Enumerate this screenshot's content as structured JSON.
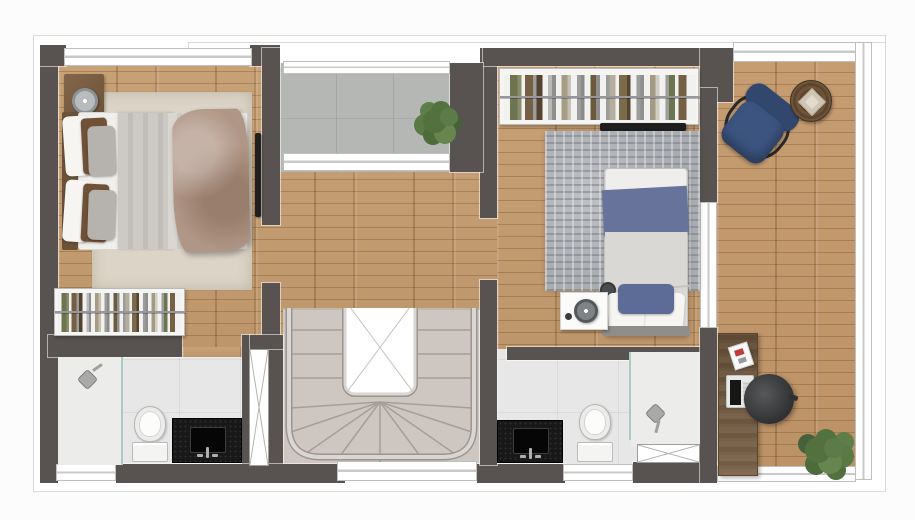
{
  "document": {
    "type": "architectural floor plan rendering",
    "view": "top-down upper floor",
    "visible_text": "none"
  },
  "palette": {
    "wall": "#585350",
    "wood": "#c59c6f",
    "deck": "#c3976a",
    "concrete": "#b5b7b5",
    "bath": "#e6e7e6",
    "stair": "#cec7c1",
    "rug1": "#dcd4c7",
    "rug2": "#a9acb1",
    "bed_blue": "#68739c",
    "chair_navy": "#3c5480",
    "vanity": "#181818",
    "glass": "#a9cdc6",
    "plant": "#5d7b49",
    "desk": "#7b6248",
    "duvet": "#b09686"
  },
  "rooms": {
    "bedroom_1": {
      "position": "top-left",
      "furniture": [
        "double-bed",
        "nightstand",
        "clock",
        "beige-rug",
        "wardrobe-rack",
        "wall-tv"
      ]
    },
    "balcony": {
      "position": "top-center",
      "furniture": [
        "potted-plant"
      ],
      "floor": "concrete"
    },
    "hallway": {
      "position": "center",
      "furniture": [],
      "floor": "wood"
    },
    "staircase": {
      "position": "bottom-center",
      "features": [
        "u-shaped-stairs",
        "central-void",
        "railing",
        "winder-treads"
      ]
    },
    "bathroom_1": {
      "position": "bottom-left",
      "furniture": [
        "walk-in-shower",
        "glass-partition",
        "toilet",
        "black-vanity-sink"
      ]
    },
    "shaft": {
      "position": "center-left-of-stairs",
      "features": [
        "duct-x-symbol"
      ]
    },
    "bedroom_2": {
      "position": "top-right",
      "furniture": [
        "single-bed-blue",
        "nightstand",
        "clock",
        "gray-rug",
        "wardrobe-rack",
        "wall-tv"
      ]
    },
    "bathroom_2": {
      "position": "bottom-right-center",
      "furniture": [
        "black-vanity-sink",
        "toilet",
        "walk-in-shower",
        "glass-partition",
        "duct-x-symbol"
      ]
    },
    "terrace": {
      "position": "right",
      "floor": "wood-deck",
      "furniture": [
        "blue-armchair",
        "round-side-table",
        "desk",
        "laptop",
        "papers",
        "office-chair",
        "potted-plant"
      ]
    }
  }
}
